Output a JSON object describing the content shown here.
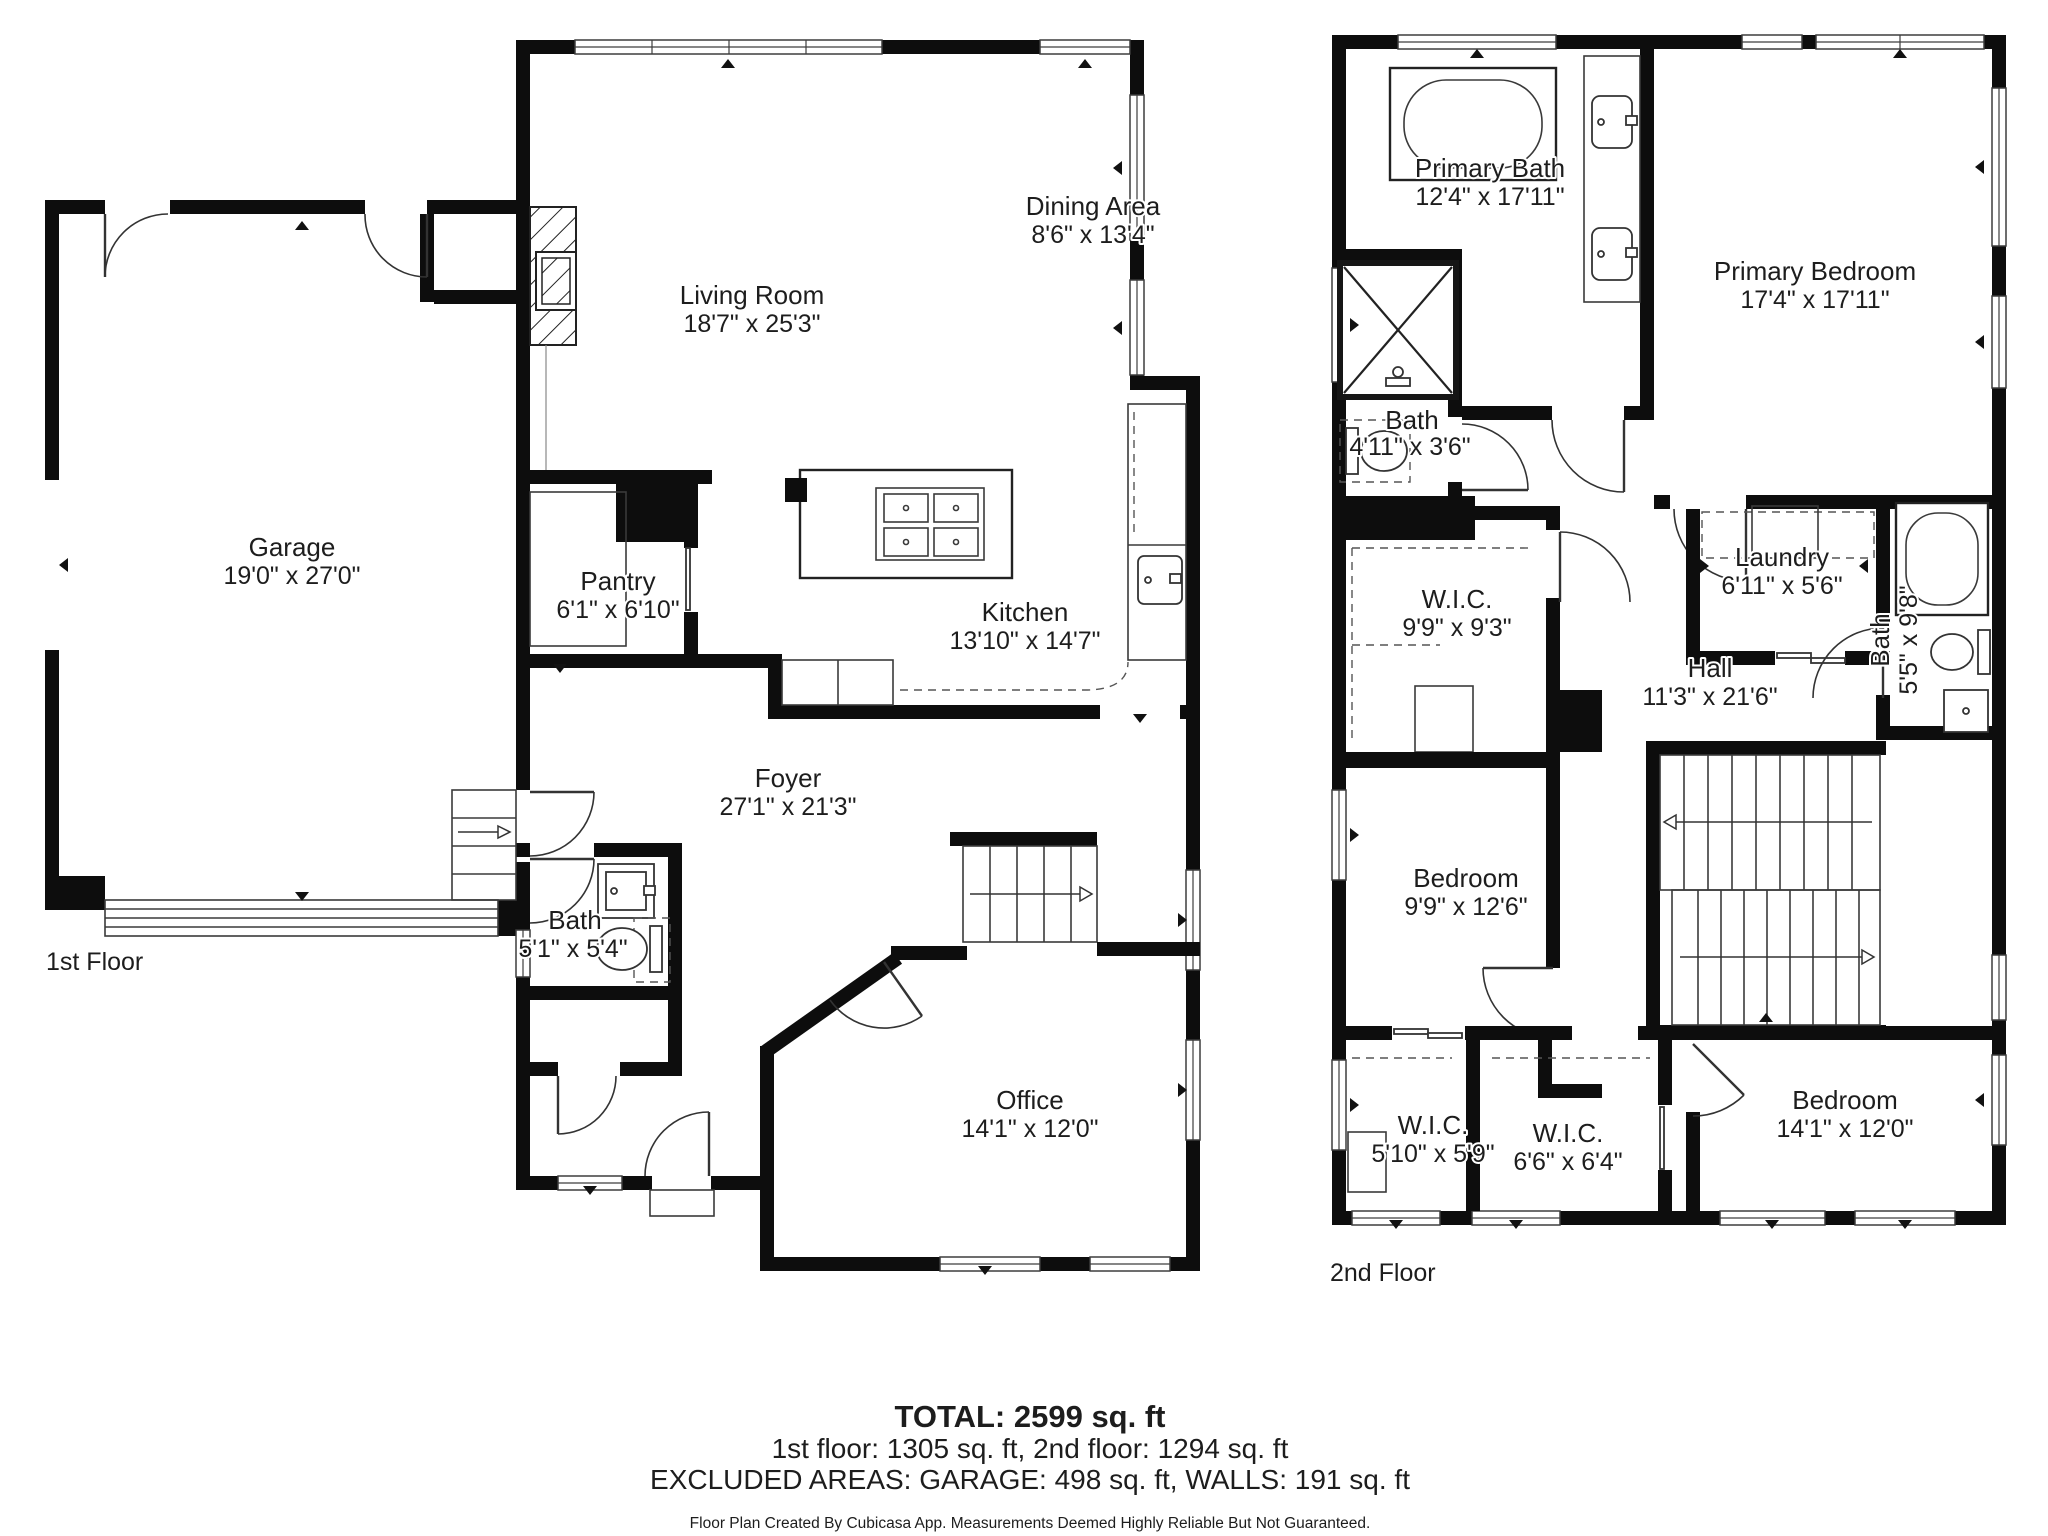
{
  "floor1": {
    "label": "1st Floor",
    "rooms": [
      {
        "name": "Garage",
        "dims": "19'0\" x 27'0\""
      },
      {
        "name": "Living Room",
        "dims": "18'7\" x 25'3\""
      },
      {
        "name": "Dining Area",
        "dims": "8'6\" x 13'4\""
      },
      {
        "name": "Pantry",
        "dims": "6'1\" x 6'10\""
      },
      {
        "name": "Kitchen",
        "dims": "13'10\" x 14'7\""
      },
      {
        "name": "Foyer",
        "dims": "27'1\" x 21'3\""
      },
      {
        "name": "Bath",
        "dims": "5'1\" x 5'4\""
      },
      {
        "name": "Office",
        "dims": "14'1\" x 12'0\""
      }
    ]
  },
  "floor2": {
    "label": "2nd Floor",
    "rooms": [
      {
        "name": "Primary Bath",
        "dims": "12'4\" x 17'11\""
      },
      {
        "name": "Primary Bedroom",
        "dims": "17'4\" x 17'11\""
      },
      {
        "name": "Bath",
        "dims": "4'11\" x 3'6\""
      },
      {
        "name": "W.I.C.",
        "dims": "9'9\" x 9'3\""
      },
      {
        "name": "Laundry",
        "dims": "6'11\" x 5'6\""
      },
      {
        "name": "Hall",
        "dims": "11'3\" x 21'6\""
      },
      {
        "name": "Bath",
        "dims": "5'5\" x 9'8\""
      },
      {
        "name": "Bedroom",
        "dims": "9'9\" x 12'6\""
      },
      {
        "name": "W.I.C.",
        "dims": "5'10\" x 5'9\""
      },
      {
        "name": "W.I.C.",
        "dims": "6'6\" x 6'4\""
      },
      {
        "name": "Bedroom",
        "dims": "14'1\" x 12'0\""
      }
    ]
  },
  "summary": {
    "total": "TOTAL: 2599 sq. ft",
    "floors": "1st floor: 1305 sq. ft, 2nd floor: 1294 sq. ft",
    "excluded": "EXCLUDED AREAS: GARAGE: 498 sq. ft, WALLS: 191 sq. ft",
    "disclaimer": "Floor Plan Created By Cubicasa App. Measurements Deemed Highly Reliable But Not Guaranteed."
  },
  "colors": {
    "wall": "#0d0d0d",
    "line": "#3a3a3a",
    "text": "#1d1d1d"
  }
}
